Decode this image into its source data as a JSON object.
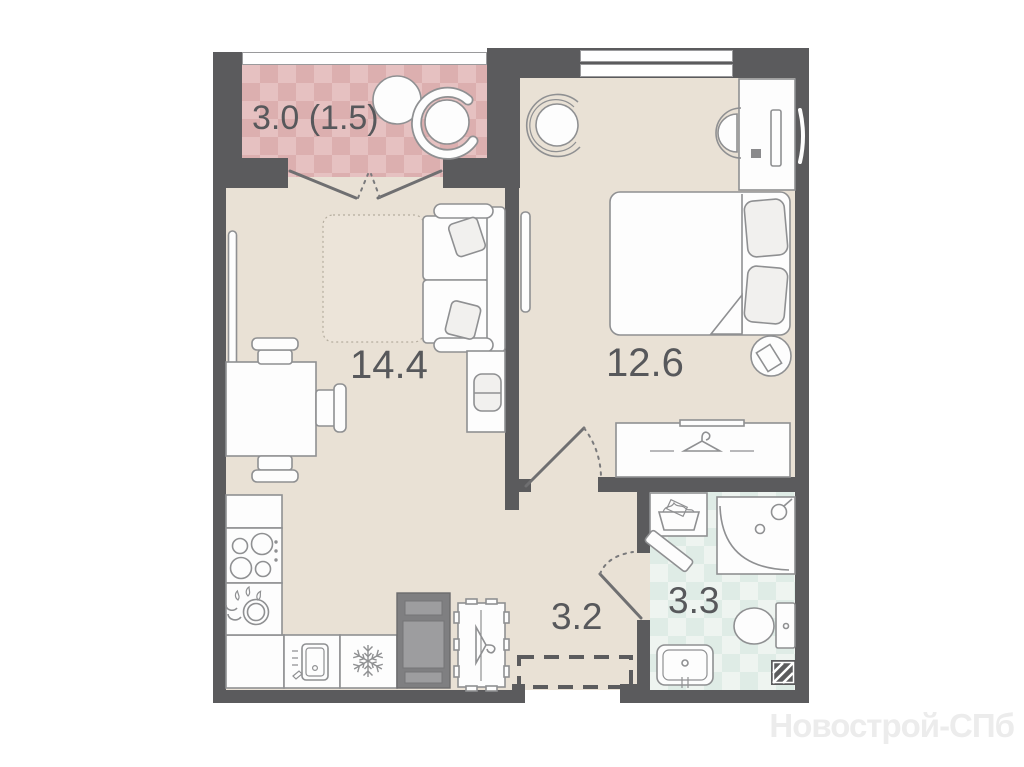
{
  "watermark": "Новострой-СПб",
  "rooms": {
    "balcony": {
      "name": "balcony",
      "area_label": "3.0 (1.5)"
    },
    "living": {
      "name": "living-room-kitchen",
      "area_label": "14.4"
    },
    "bedroom": {
      "name": "bedroom",
      "area_label": "12.6"
    },
    "hallway": {
      "name": "hallway",
      "area_label": "3.2"
    },
    "bathroom": {
      "name": "bathroom",
      "area_label": "3.3"
    }
  },
  "colors": {
    "wall": "#5b5b5d",
    "floor": "#e9e1d5",
    "rug": "#ece4d9",
    "balcony_base": "#e6c1c1",
    "balcony_accent": "#dcafaf",
    "bath_base": "#eef4f0",
    "bath_accent": "#dfece6",
    "outline": "#8f9092",
    "label": "#57585b",
    "watermark": "#ececec"
  },
  "icons": [
    "hanger-icon",
    "snowflake-icon",
    "stove-burners-icon",
    "dish-rack-icon",
    "kitchen-sink-icon",
    "shower-icon",
    "toilet-icon",
    "washbasin-icon",
    "laundry-basket-icon",
    "duct-hatch-icon",
    "tv-icon",
    "monitor-icon"
  ]
}
